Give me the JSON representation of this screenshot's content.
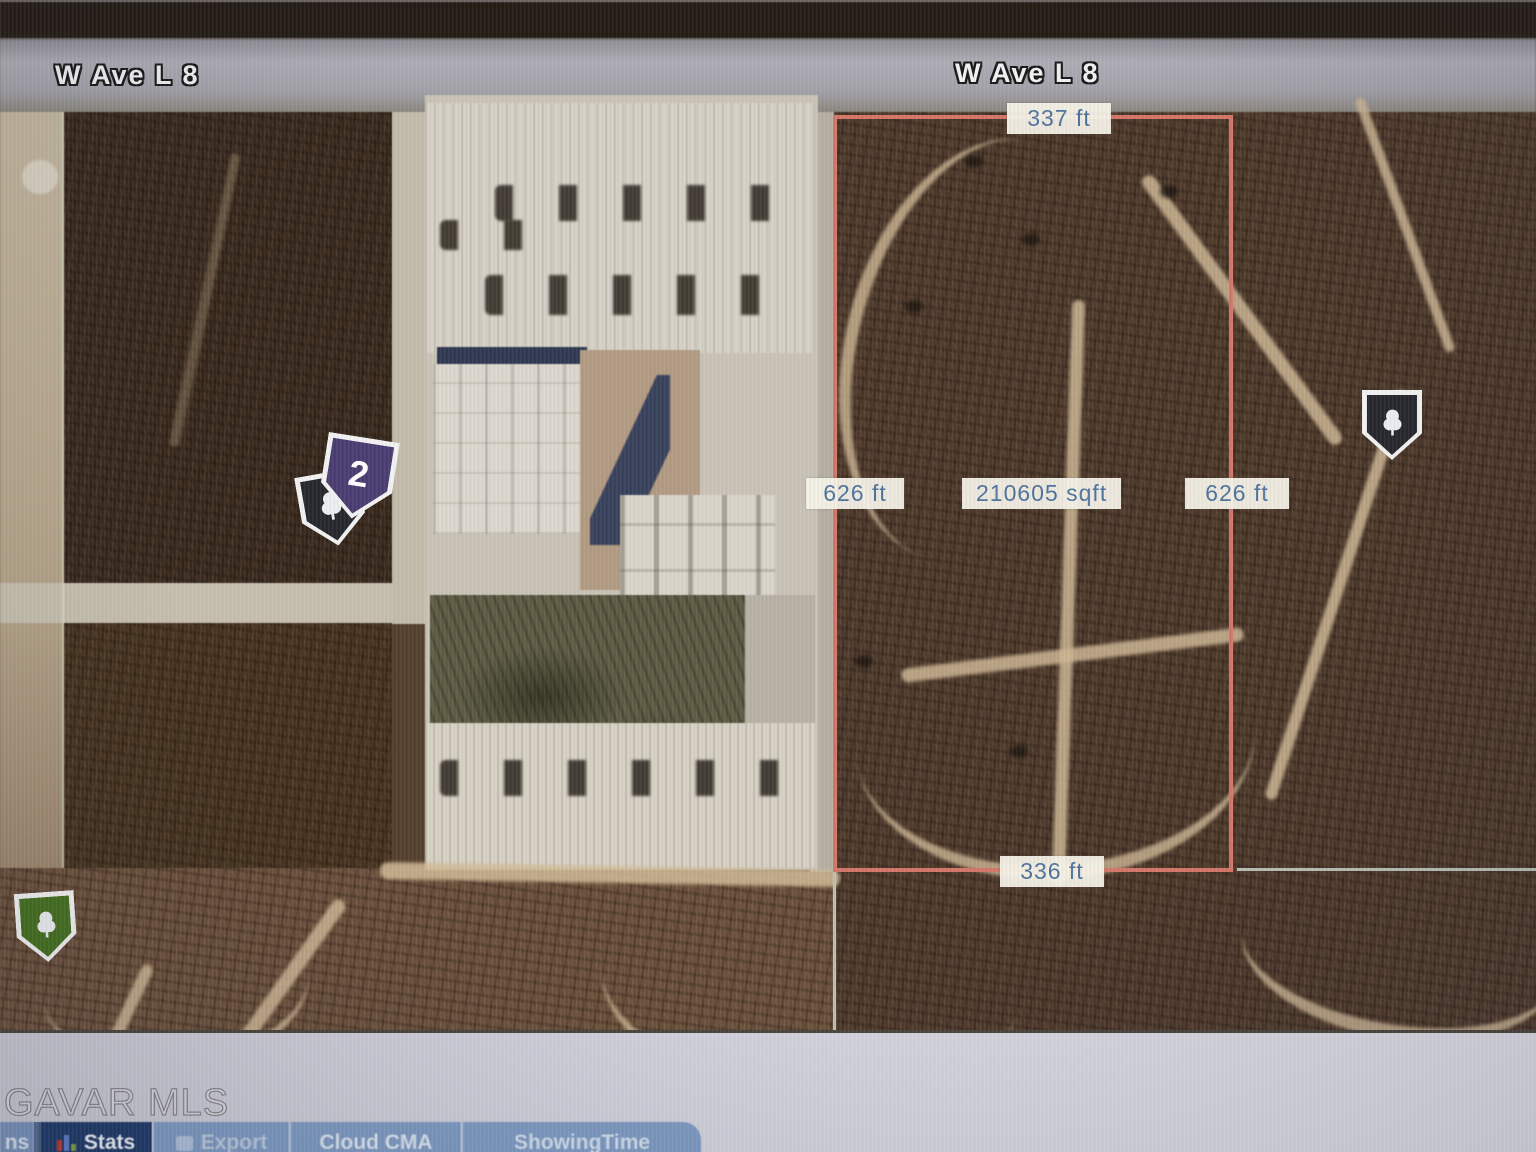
{
  "map": {
    "street_labels": [
      {
        "text": "W Ave L 8"
      },
      {
        "text": "W Ave L 8"
      }
    ],
    "parcel": {
      "top_length": "337 ft",
      "left_length": "626 ft",
      "area": "210605 sqft",
      "right_length": "626 ft",
      "bottom_length": "336 ft",
      "outline_color": "#d47668",
      "label_bg": "#f5f2e8",
      "label_text_color": "#4f739e"
    },
    "markers": {
      "cluster": {
        "count": "2",
        "color": "#4b3d72",
        "companion_color": "#26282e",
        "icon": "tree-icon"
      },
      "right_pin": {
        "color": "#26282e",
        "icon": "tree-icon"
      },
      "green_pin": {
        "color": "#44701f",
        "icon": "tree-icon"
      }
    }
  },
  "watermark": "GAVAR MLS",
  "toolbar": {
    "partial_left_label": "ns",
    "buttons": [
      {
        "label": "Stats",
        "icon": "bar-chart-icon",
        "active": true
      },
      {
        "label": "Export",
        "icon": "export-icon",
        "active": false
      },
      {
        "label": "Cloud CMA",
        "icon": "",
        "active": false
      },
      {
        "label": "ShowingTime",
        "icon": "",
        "active": false
      }
    ]
  }
}
